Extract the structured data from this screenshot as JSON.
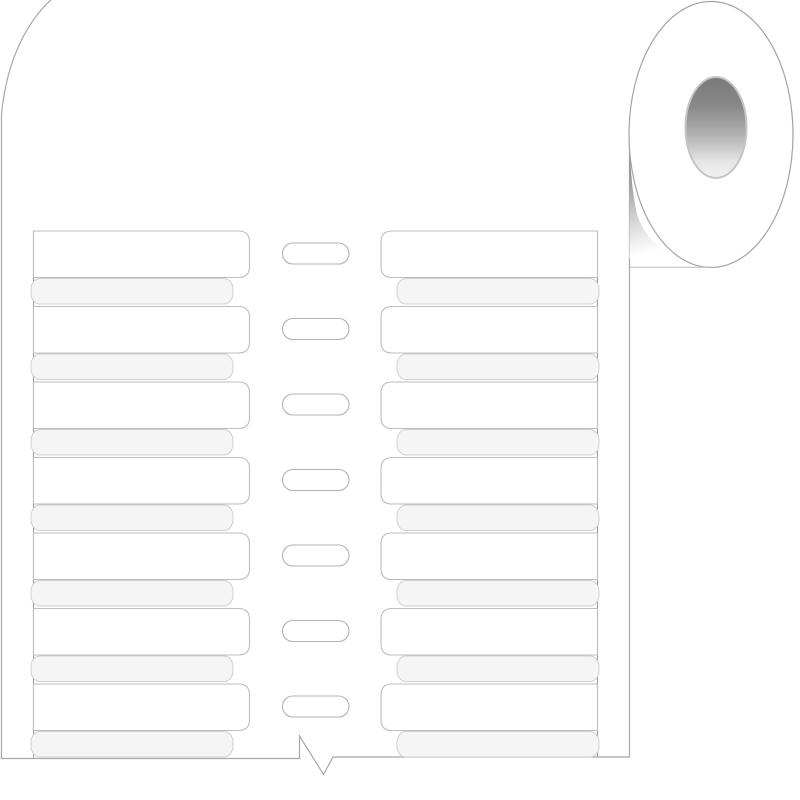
{
  "illustration": {
    "name": "blank-label-roll-product-drawing",
    "description": "Roll of blank white sleeve labels wound on a core, with the liner sheet unrolled below showing two columns of empty labels and center feed slots",
    "label_rows": 7,
    "feed_slots": 7,
    "label_columns": 2,
    "colors": {
      "background": "#ffffff",
      "sheet_outline": "#a8a8a8",
      "rail_line": "#9c9c9c",
      "label_fill": "#ffffff",
      "label_border": "#bdbdbd",
      "band_fill": "#f5f5f6",
      "band_border": "#d0d0d0",
      "slot_border": "#b3b3b3",
      "roll_outline": "#a3a3a3",
      "nip_line": "#bcbcbc",
      "core_ring": "#c4c4c4",
      "core_stops": [
        "#787878",
        "#8a8a8a",
        "#b2b2b2",
        "#e3e3e3",
        "#f2f2f2"
      ],
      "core_stop_offsets": [
        0,
        0.3,
        0.58,
        0.82,
        1
      ],
      "wedge_stops": [
        "#6e6e6e",
        "#a0a0a0",
        "#d8d8d8",
        "#ffffff"
      ],
      "wedge_stop_offsets": [
        0,
        0.35,
        0.7,
        1
      ]
    }
  }
}
